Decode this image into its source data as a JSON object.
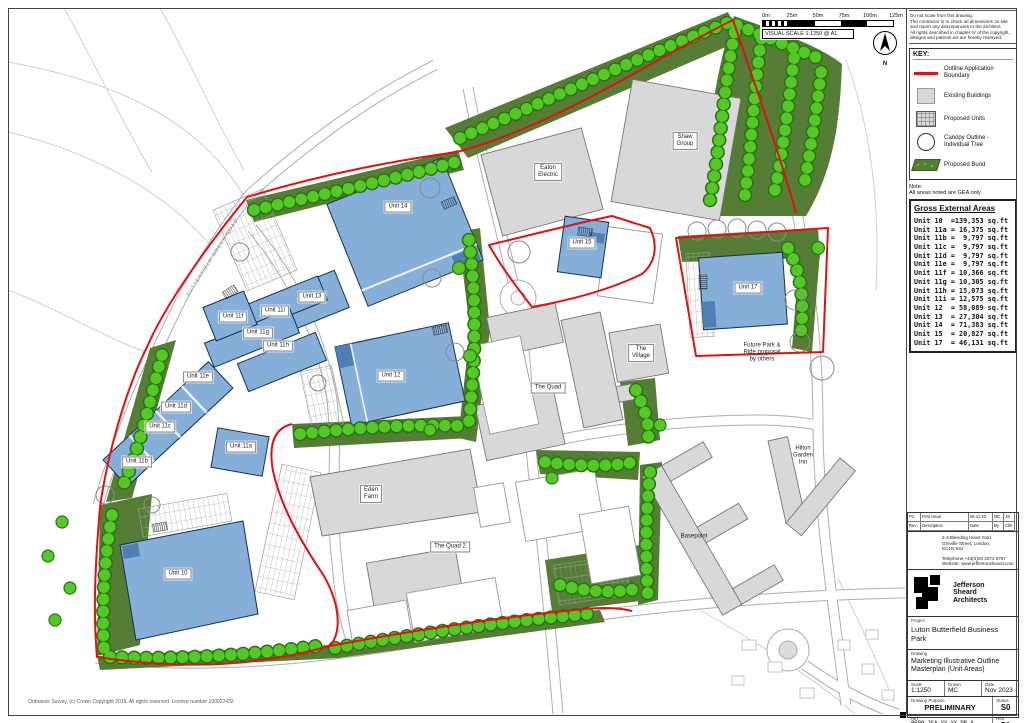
{
  "scalebar": {
    "ticks": [
      "0m",
      "25m",
      "50m",
      "75m",
      "100m",
      "125m"
    ],
    "caption": "VISUAL SCALE 1:1250 @ A1",
    "north": "N"
  },
  "notes_top": {
    "lines": [
      "Do not scale from this drawing.",
      "The contractor is to check all dimensions on site and report any discrepancies to the architect.",
      "All rights described in chapter IV of the copyright, designs and patents act are hereby reserved."
    ]
  },
  "key": {
    "title": "KEY:",
    "items": [
      {
        "label": "Outline Application Boundary"
      },
      {
        "label": "Existing Buildings"
      },
      {
        "label": "Proposed Units"
      },
      {
        "label": "Canopy Outline -\nIndividual Tree"
      },
      {
        "label": "Proposed Bund"
      }
    ]
  },
  "areas_note": {
    "label": "Note:",
    "text": "All areas noted are GEA only"
  },
  "gea": {
    "title": "Gross External Areas",
    "rows": [
      "Unit 10  =139,353 sq.ft",
      "Unit 11a = 16,375 sq.ft",
      "Unit 11b =  9,797 sq.ft",
      "Unit 11c =  9,797 sq.ft",
      "Unit 11d =  9,797 sq.ft",
      "Unit 11e =  9,797 sq.ft",
      "Unit 11f = 10,366 sq.ft",
      "Unit 11g = 10,305 sq.ft",
      "Unit 11h = 15,073 sq.ft",
      "Unit 11i = 12,575 sq.ft",
      "Unit 12  = 58,089 sq.ft",
      "Unit 13  = 27,304 sq.ft",
      "Unit 14  = 71,383 sq.ft",
      "Unit 15  = 20,827 sq.ft",
      "Unit 17  = 46,131 sq.ft"
    ]
  },
  "map": {
    "copyright": "Ordnance Survey, (c) Crown Copyright 2015. All rights reserved. Licence number 100022432",
    "labels": {
      "unit10": "Unit 10",
      "unit11a": "Unit 11a",
      "unit11b": "Unit 11b",
      "unit11c": "Unit 11c",
      "unit11d": "Unit 11d",
      "unit11e": "Unit 11e",
      "unit11f": "Unit 11f",
      "unit11g": "Unit 11g",
      "unit11h": "Unit 11h",
      "unit11i": "Unit 11i",
      "unit12": "Unit 12",
      "unit13": "Unit 13",
      "unit14": "Unit 14",
      "unit15": "Unit 15",
      "unit17": "Unit 17",
      "eaton": "Eaton\nElectric",
      "shaw": "Shaw\nGroup",
      "village": "The\nVillage",
      "quad": "The Quad",
      "eden": "Eden\nFarm",
      "quad2": "The Quad 2",
      "basepoint": "Basepoint",
      "hilton": "Hilton\nGarden\nInn",
      "parkride": "Future Park &\nRide proposal\nby others",
      "road": "BUTTERFIELD GREEN ROAD"
    }
  },
  "titleblock": {
    "revtable": {
      "header": [
        "Rev",
        "Description",
        "Date",
        "By",
        "Chk"
      ],
      "row": [
        "P1",
        "First Issue",
        "06.11.23",
        "MC",
        "JS"
      ]
    },
    "address_lines": [
      "2-3 Bleeding Heart Yard,",
      "Greville Street, London,",
      "EC1N 8SJ"
    ],
    "phone": "Telephone +44(0)20 3074 9767",
    "website": "Website: www.jeffersonsheard.com",
    "logo_text": "Jefferson\nSheard\nArchitects",
    "project_label": "Project",
    "project": "Luton Butterfield Business Park",
    "drawing_label": "Drawing",
    "drawing": "Marketing Illustrative Outline\nMasterplan (Unit Areas)",
    "scale_label": "Scale",
    "scale": "1:1250",
    "drawn_label": "Drawn",
    "drawn": "MC",
    "date_label": "Date",
    "date": "Nov 2023",
    "purpose_label": "Drawing Purpose",
    "purpose": "PRELIMINARY",
    "status_label": "Status",
    "status": "S0",
    "ref_label": "Ref",
    "ref": "0689-JSA-XX-XX-DR-A-01220",
    "rev_label": "Rev",
    "rev": "P1",
    "footnote": "Job No - Origin - Zone Level Type Rol Number"
  },
  "colors": {
    "boundary": "#e01212",
    "proposed_unit": "#85afd9",
    "existing_building": "#d8d8d8",
    "bund": "#567d36",
    "tree": "#54c926"
  }
}
